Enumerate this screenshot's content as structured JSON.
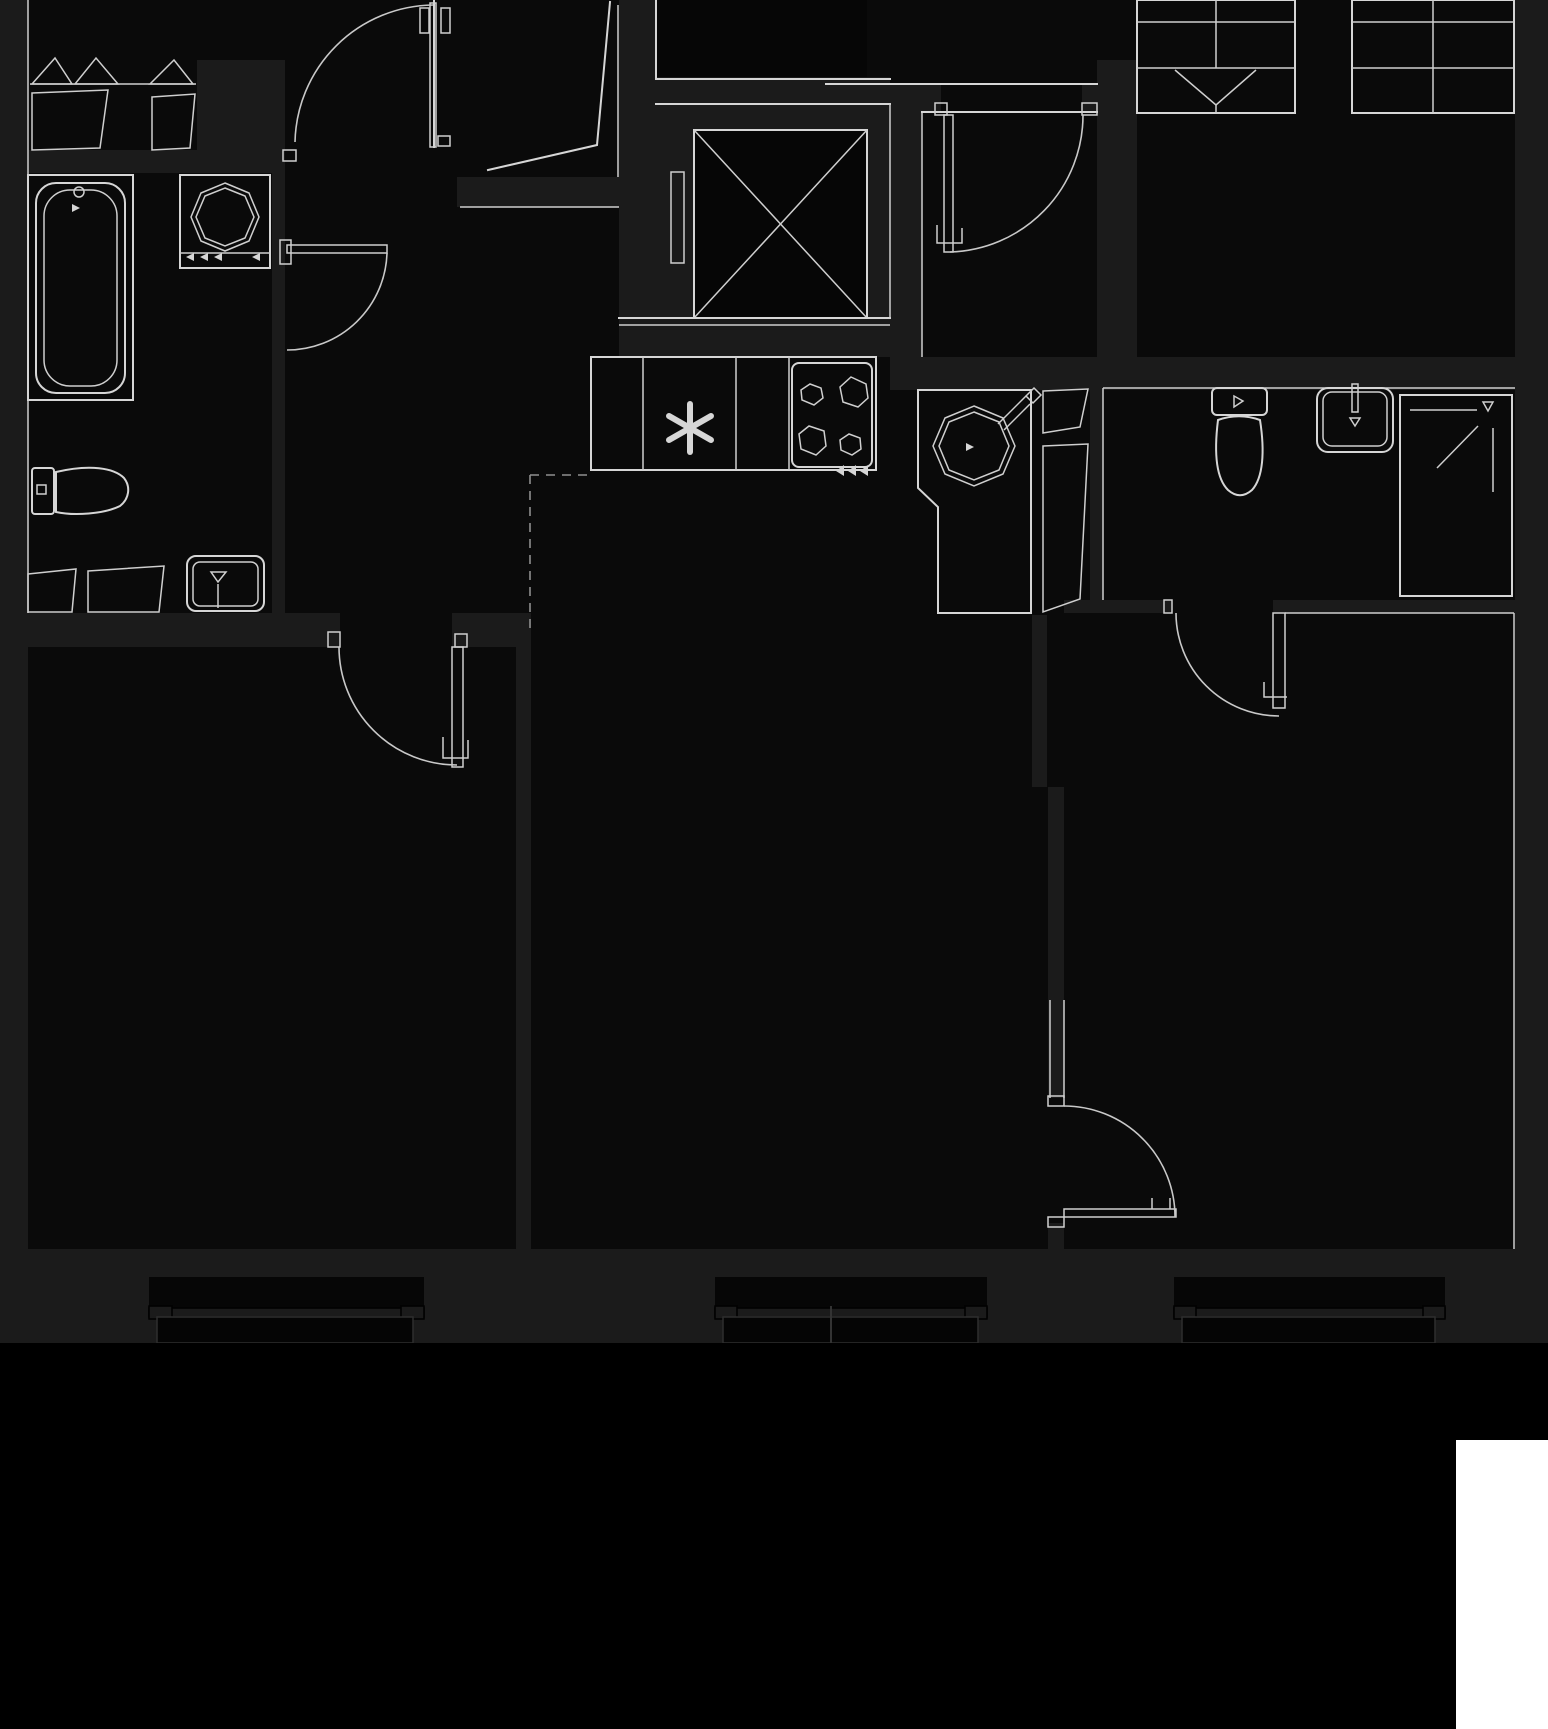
{
  "meta": {
    "title": "Apartment floor plan (dark theme, no text labels)",
    "type": "architectural-floor-plan",
    "canvas": {
      "width": 1548,
      "height": 1729
    }
  },
  "colors": {
    "background": "#000000",
    "room_fill": "#0a0a0a",
    "wall_fill": "#1b1b1b",
    "line": "#d6d6d6",
    "highlight_rect": "#ffffff"
  },
  "legend": {
    "rooms": [
      "entry-hall-with-closet",
      "bathroom-1",
      "kitchen-zone",
      "living-room",
      "bedroom-left",
      "bedroom-right",
      "bathroom-2",
      "dressing-hall-with-wardrobes",
      "elevator-shaft"
    ],
    "fixtures": [
      "bathtub",
      "washing-machine",
      "toilet-1",
      "vanity-washbasin",
      "kitchen-sink-asterisk",
      "hob-4-burners",
      "corner-round-sink",
      "toilet-2",
      "washbasin-2",
      "shower-cabin",
      "wardrobe-with-hangers",
      "wardrobe-with-shelves"
    ],
    "doors": 6,
    "windows": 3
  },
  "windows": [
    {
      "name": "window-bedroom-left",
      "x1": 149,
      "x2": 424
    },
    {
      "name": "window-living-room",
      "x1": 715,
      "x2": 987
    },
    {
      "name": "window-bedroom-right",
      "x1": 1174,
      "x2": 1445
    }
  ],
  "highlight": {
    "x": 1456,
    "y": 1440,
    "width": 92,
    "height": 289
  }
}
